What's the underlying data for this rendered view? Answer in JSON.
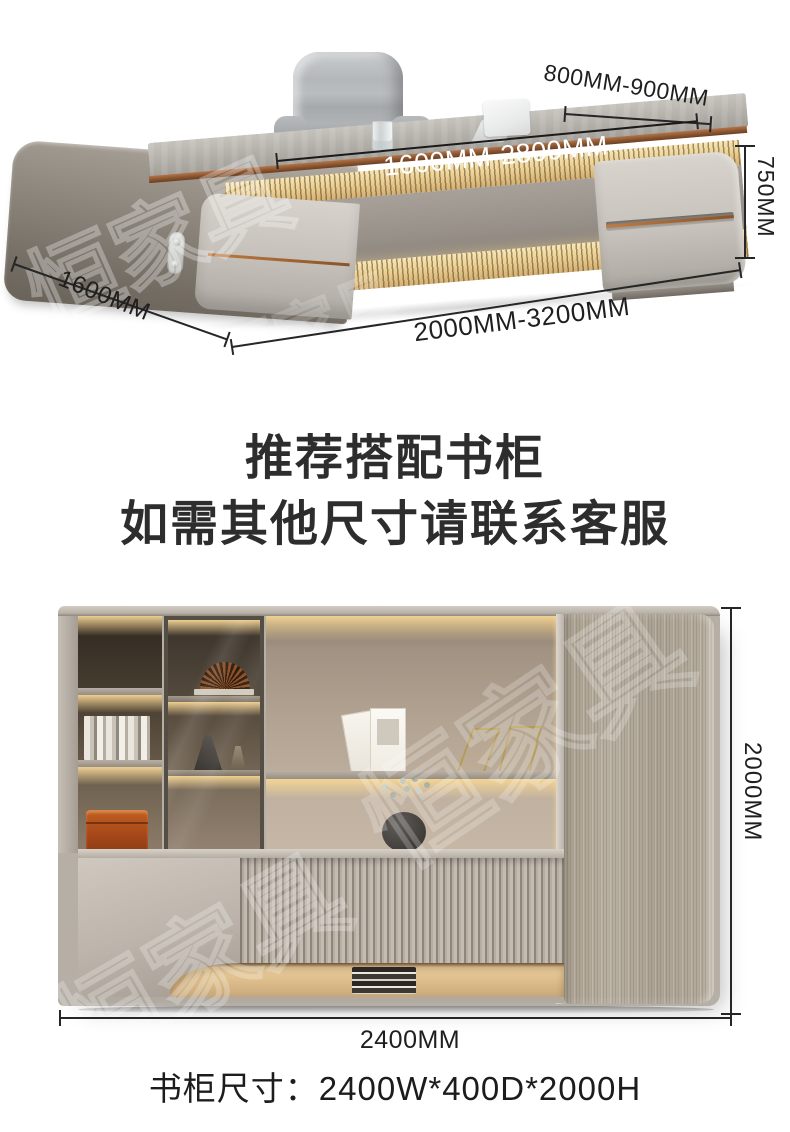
{
  "desk_figure": {
    "annotations": {
      "top_depth": "800MM-900MM",
      "top_length": "1600MM-2800MM",
      "height": "750MM",
      "side_depth": "1600MM",
      "bottom_length": "2000MM-3200MM"
    }
  },
  "headings": {
    "line1": "推荐搭配书柜",
    "line2": "如需其他尺寸请联系客服"
  },
  "bookcase_figure": {
    "annotations": {
      "height": "2000MM",
      "width": "2400MM"
    },
    "caption": "书柜尺寸：2400W*400D*2000H"
  },
  "watermark": {
    "text": "恒家具"
  },
  "colors": {
    "background": "#ffffff",
    "dimension_text": "#1f1f1f",
    "heading_text": "#2d2d2d",
    "copper_accent": "#8a5530",
    "led_glow": "#f2d9a2",
    "orange_box": "#a8491a",
    "cabinet_gray": "#b6afa6"
  }
}
